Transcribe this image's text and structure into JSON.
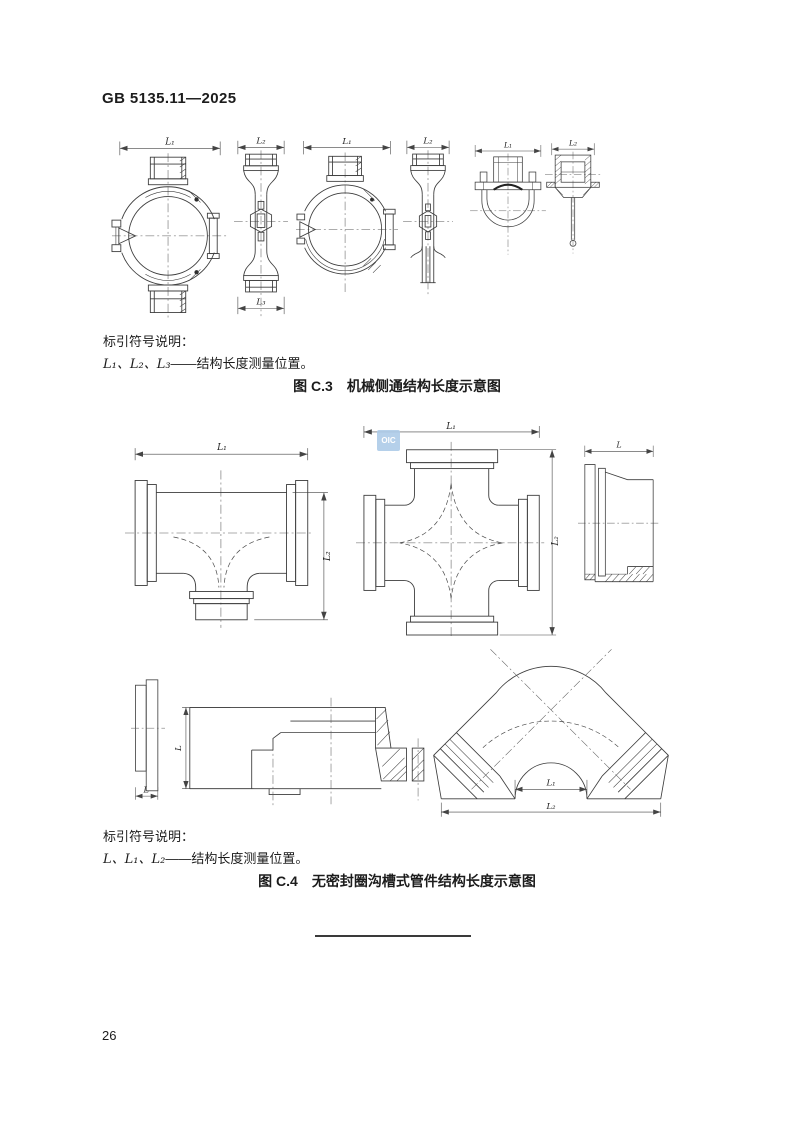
{
  "page": {
    "header": "GB 5135.11—2025",
    "page_number": "26"
  },
  "watermark": {
    "text": "OIC"
  },
  "dim_labels": {
    "l": "L",
    "l1": "L₁",
    "l2": "L₂",
    "l3": "L₃"
  },
  "figure_c3": {
    "legend_title": "标引符号说明：",
    "legend_symbols": "L₁、L₂、L₃",
    "legend_dash": "——",
    "legend_desc": "结构长度测量位置。",
    "caption_number": "图 C.3",
    "caption_title": "机械侧通结构长度示意图"
  },
  "figure_c4": {
    "legend_title": "标引符号说明：",
    "legend_symbols": "L、L₁、L₂",
    "legend_dash": "——",
    "legend_desc": "结构长度测量位置。",
    "caption_number": "图 C.4",
    "caption_title": "无密封圈沟槽式管件结构长度示意图"
  }
}
